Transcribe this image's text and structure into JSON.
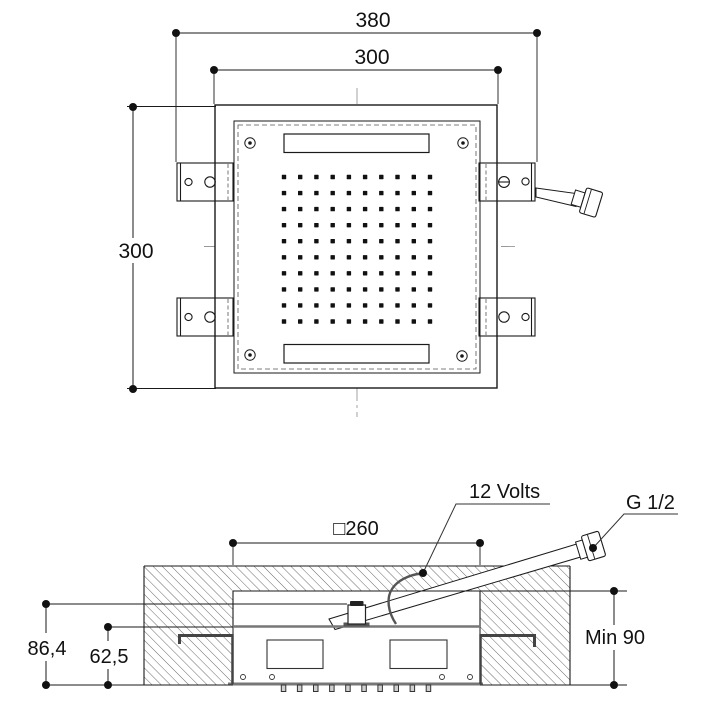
{
  "top_view": {
    "dim_width_overall": "380",
    "dim_width_plate": "300",
    "dim_height_plate": "300"
  },
  "section_view": {
    "dim_cutout_square": "□260",
    "label_power": "12 Volts",
    "label_connection": "G 1/2",
    "dim_height_overall": "86,4",
    "dim_height_body": "62,5",
    "dim_min_recess": "Min 90"
  },
  "colors": {
    "line": "#1a1a1a",
    "thick_line": "#777777",
    "hatch": "#444444",
    "centerline": "#999999"
  }
}
